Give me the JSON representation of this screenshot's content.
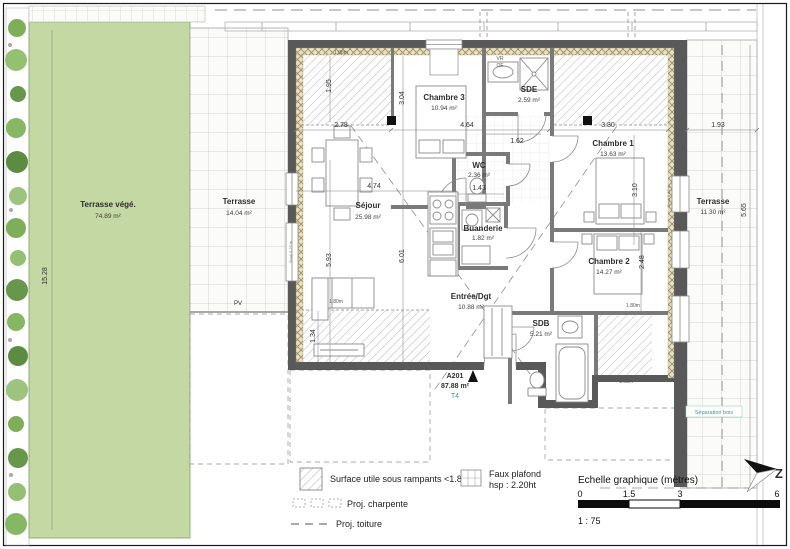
{
  "unit": {
    "code": "A201",
    "area": "87.88 m²",
    "type": "T4"
  },
  "rooms": [
    {
      "name": "Terrasse végé.",
      "area": "74.89 m²"
    },
    {
      "name": "Terrasse",
      "area": "14.04 m²"
    },
    {
      "name": "Séjour",
      "area": "25.98 m²"
    },
    {
      "name": "Chambre 3",
      "area": "10.94 m²"
    },
    {
      "name": "SDE",
      "area": "2.59 m²"
    },
    {
      "name": "WC",
      "area": "2.36 m²"
    },
    {
      "name": "Buanderie",
      "area": "1.82 m²"
    },
    {
      "name": "Chambre 1",
      "area": "13.63 m²"
    },
    {
      "name": "Chambre 2",
      "area": "14.27 m²"
    },
    {
      "name": "Entrée/Dgt",
      "area": "10.88 m²"
    },
    {
      "name": "SDB",
      "area": "5.21 m²"
    },
    {
      "name": "Terrasse",
      "area": "11.30 m²"
    }
  ],
  "dims": {
    "sejour_top_w": "2.78",
    "chambre3_w": "4.64",
    "sde_w": "1.62",
    "chambre1_w": "3.80",
    "terrasse_e_w": "1.93",
    "chambre3_h": "3.04",
    "rampant_nw": "1.95",
    "chambre1_h": "3.10",
    "sejour_w": "4.74",
    "wc_w": "1.43",
    "sejour_h_l": "5.93",
    "sejour_h_r": "6.01",
    "chambre2_h": "2.48",
    "terrasse_vege_h": "15.28",
    "terrasse_e_h": "5.65",
    "rampant_sw": "1.34",
    "chambre2_foot": "1.80m",
    "sofa_w": "1.80m",
    "rampant_se": "1.08m",
    "rampant_nw_top": "1.08m",
    "seuil_r": "Seuil 0.35 m",
    "seuil_l": "Seuil 0.25 m"
  },
  "annotations": {
    "vr": "VR",
    "of": "OF",
    "pv": "PV",
    "separation_bois": "Séparation bois"
  },
  "legend": {
    "rampants": "Surface utile sous rampants <1.80m",
    "faux_plafond_1": "Faux plafond",
    "faux_plafond_2": "hsp : 2.20ht",
    "charpente": "Proj. charpente",
    "toiture": "Proj. toiture"
  },
  "scale": {
    "title": "Echelle graphique (mètres)",
    "ticks": [
      "0",
      "1.5",
      "3",
      "6"
    ],
    "ratio": "1 : 75"
  },
  "compass": {
    "letter": "Z"
  },
  "colors": {
    "terrace_green": "#c3d8a2",
    "wall_dark": "#595959",
    "insulation": "#e8e0c2",
    "teal": "#2fa08e"
  }
}
